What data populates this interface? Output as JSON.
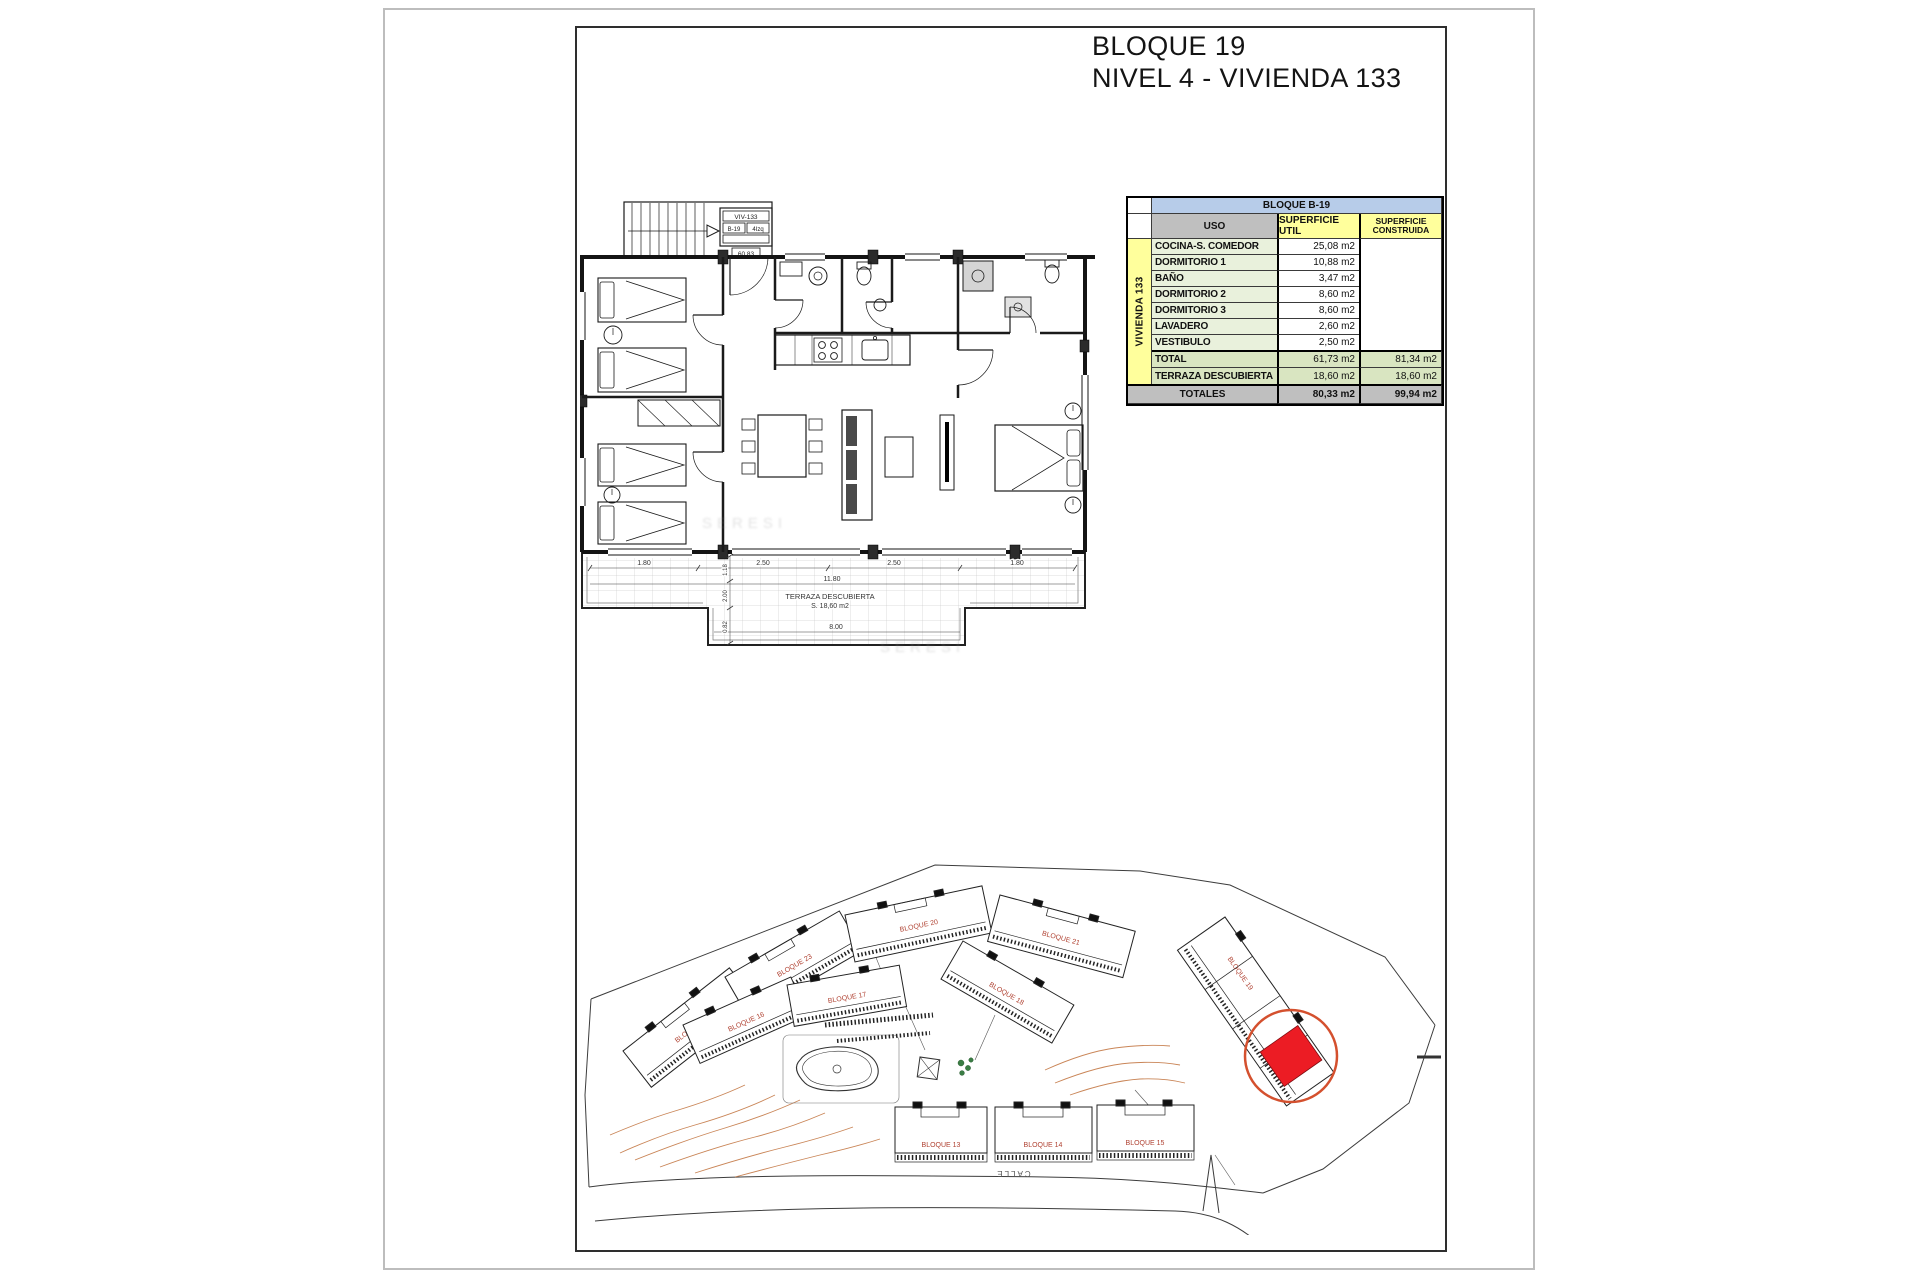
{
  "page": {
    "title_line1": "BLOQUE 19",
    "title_line2": "NIVEL 4 - VIVIENDA 133"
  },
  "area_table": {
    "block_header": "BLOQUE B-19",
    "col_uso": "USO",
    "col_util": "SUPERFICIE UTIL",
    "col_construida_1": "SUPERFICIE",
    "col_construida_2": "CONSTRUIDA",
    "row_group_label": "VIVIENDA 133",
    "rows": [
      {
        "label": "COCINA-S. COMEDOR",
        "util": "25,08 m2"
      },
      {
        "label": "DORMITORIO 1",
        "util": "10,88 m2"
      },
      {
        "label": "BAÑO",
        "util": "3,47 m2"
      },
      {
        "label": "DORMITORIO 2",
        "util": "8,60 m2"
      },
      {
        "label": "DORMITORIO 3",
        "util": "8,60 m2"
      },
      {
        "label": "LAVADERO",
        "util": "2,60 m2"
      },
      {
        "label": "VESTIBULO",
        "util": "2,50 m2"
      }
    ],
    "total": {
      "label": "TOTAL",
      "util": "61,73 m2",
      "construida": "81,34 m2"
    },
    "terraza": {
      "label": "TERRAZA DESCUBIERTA",
      "util": "18,60 m2",
      "construida": "18,60 m2"
    },
    "totales": {
      "label": "TOTALES",
      "util": "80,33 m2",
      "construida": "99,94 m2"
    }
  },
  "floorplan": {
    "legend_unit": "VIV-133",
    "legend_block": "B-19",
    "legend_pos": "4Izq",
    "legend_code": "60.83",
    "terrace_name": "TERRAZA DESCUBIERTA",
    "terrace_area": "S. 18,60 m2",
    "dim_top_1": "1.80",
    "dim_top_2": "2.50",
    "dim_top_3": "2.50",
    "dim_top_4": "1.80",
    "dim_width": "11.80",
    "dim_bottom": "8.00",
    "dim_v1": "1.18",
    "dim_v2": "2.00",
    "dim_v3": "0.82",
    "watermark": "SERESI"
  },
  "siteplan": {
    "street": "CALLE",
    "blocks": {
      "b13": "BLOQUE 13",
      "b14": "BLOQUE 14",
      "b15": "BLOQUE 15",
      "b16": "BLOQUE 16",
      "b17": "BLOQUE 17",
      "b18": "BLOQUE 18",
      "b19": "BLOQUE 19",
      "b20": "BLOQUE 20",
      "b21": "BLOQUE 21",
      "b22": "BLOQUE 22",
      "b23": "BLOQUE 23"
    }
  },
  "colors": {
    "highlight_unit_red": "#ec1c24",
    "highlight_circle": "#d4502e",
    "block_label_red": "#b04232",
    "table_header_blue": "#b7cce9",
    "table_header_gray": "#bfbfbf",
    "table_header_yellow": "#ffff9c",
    "table_row_green": "#e9f1dc",
    "table_total_green": "#d9e5c1",
    "contour_orange": "#c0703a"
  }
}
